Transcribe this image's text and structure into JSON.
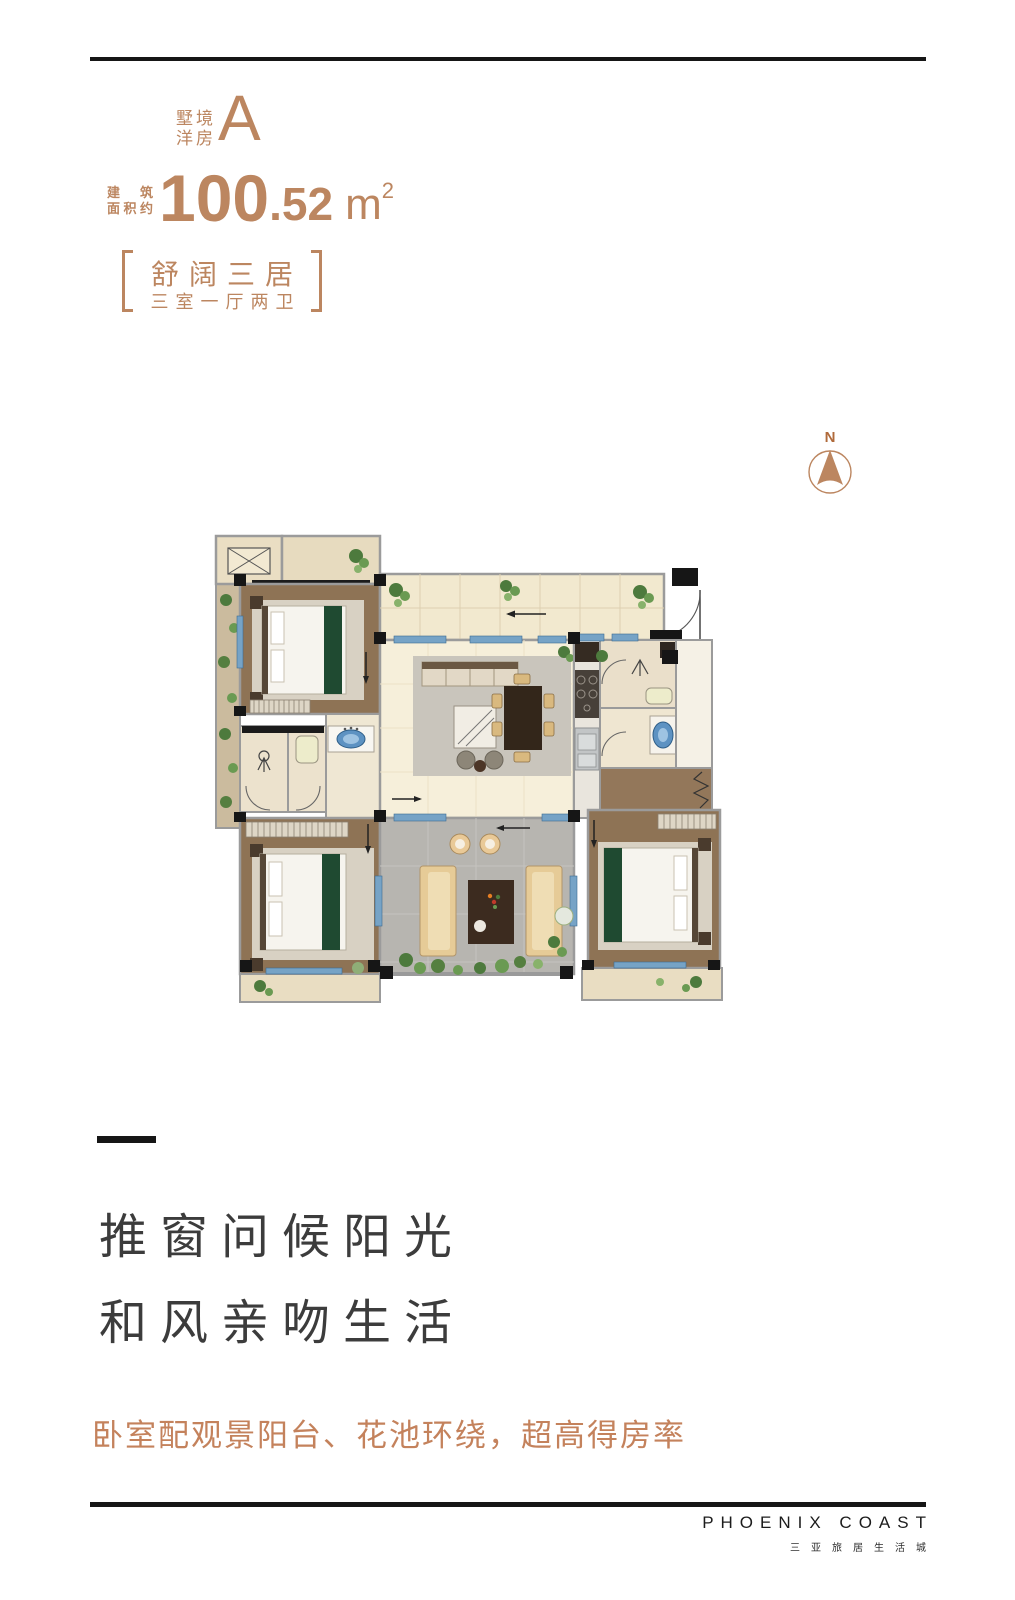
{
  "colors": {
    "accent": "#bc8660",
    "headline_text": "#3c3c3c",
    "highlight_text": "#c4825c",
    "rule": "#161616"
  },
  "header": {
    "unit_label_line1": "墅境",
    "unit_label_line2": "洋房",
    "unit_letter": "A",
    "area_prefix_line1": "建 筑",
    "area_prefix_line2": "面积约",
    "area_integer": "100",
    "area_decimal": ".52",
    "area_unit": "m",
    "area_unit_sup": "2",
    "tagline": "舒阔三居",
    "tagline_sub": "三室一厅两卫"
  },
  "compass": {
    "label": "N"
  },
  "headline": {
    "line1": "推窗问候阳光",
    "line2": "和风亲吻生活"
  },
  "highlight": "卧室配观景阳台、花池环绕，超高得房率",
  "footer": {
    "brand_en": "PHOENIX COAST",
    "brand_cn": "三亚旅居生活城"
  }
}
